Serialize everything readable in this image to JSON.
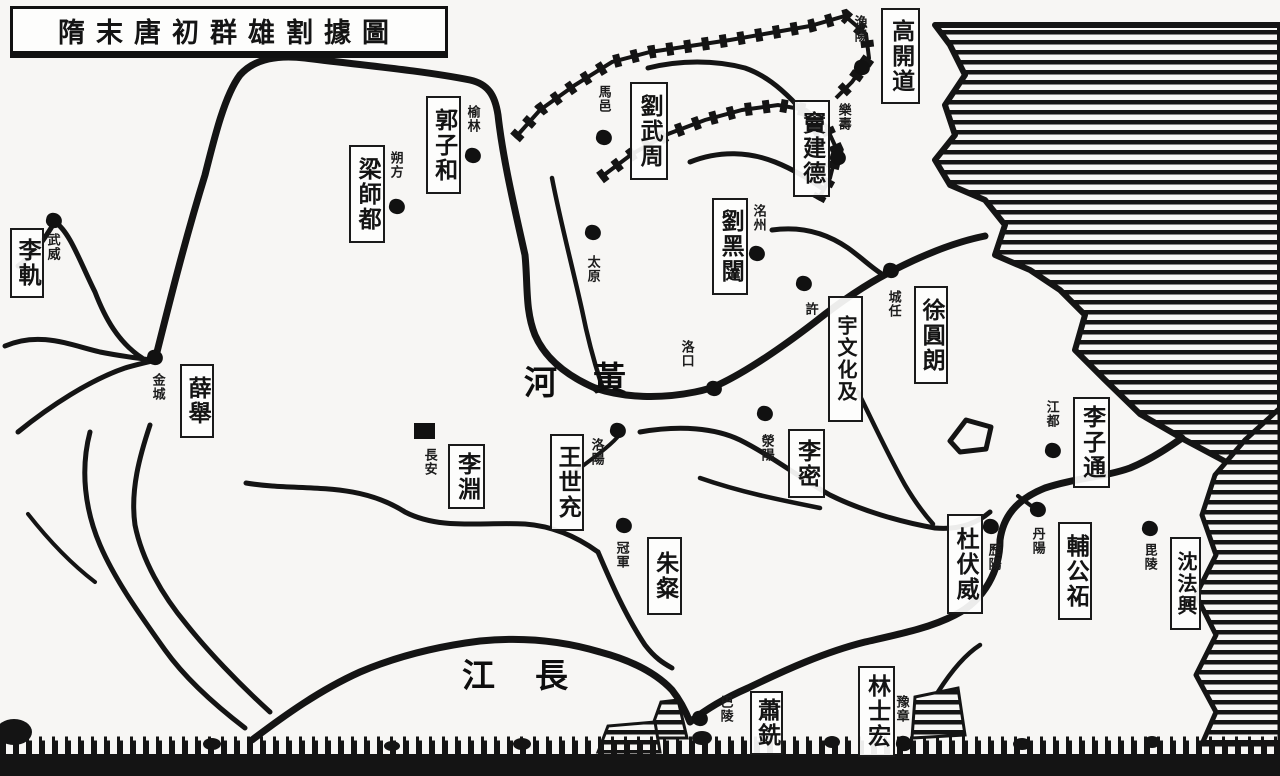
{
  "title": "隋末唐初群雄割據圖",
  "map": {
    "legend_hint": "",
    "warlords": [
      {
        "name": "高開道",
        "x": 881,
        "y": 8,
        "w": 39,
        "h": 96
      },
      {
        "name": "劉武周",
        "x": 630,
        "y": 82,
        "w": 38,
        "h": 98
      },
      {
        "name": "竇建德",
        "x": 793,
        "y": 100,
        "w": 37,
        "h": 97
      },
      {
        "name": "郭子和",
        "x": 426,
        "y": 96,
        "w": 35,
        "h": 98
      },
      {
        "name": "梁師都",
        "x": 349,
        "y": 145,
        "w": 36,
        "h": 98
      },
      {
        "name": "李軌",
        "x": 10,
        "y": 228,
        "w": 34,
        "h": 70
      },
      {
        "name": "劉黑闥",
        "x": 712,
        "y": 198,
        "w": 36,
        "h": 97
      },
      {
        "name": "薛舉",
        "x": 180,
        "y": 364,
        "w": 34,
        "h": 74
      },
      {
        "name": "宇文化及",
        "x": 828,
        "y": 296,
        "w": 35,
        "h": 126
      },
      {
        "name": "徐圓朗",
        "x": 914,
        "y": 286,
        "w": 34,
        "h": 98
      },
      {
        "name": "李淵",
        "x": 448,
        "y": 444,
        "w": 37,
        "h": 65
      },
      {
        "name": "王世充",
        "x": 550,
        "y": 434,
        "w": 34,
        "h": 97
      },
      {
        "name": "李密",
        "x": 788,
        "y": 429,
        "w": 37,
        "h": 69
      },
      {
        "name": "朱粲",
        "x": 647,
        "y": 537,
        "w": 35,
        "h": 78
      },
      {
        "name": "杜伏威",
        "x": 947,
        "y": 514,
        "w": 36,
        "h": 100
      },
      {
        "name": "輔公祏",
        "x": 1058,
        "y": 522,
        "w": 34,
        "h": 98
      },
      {
        "name": "李子通",
        "x": 1073,
        "y": 397,
        "w": 37,
        "h": 91
      },
      {
        "name": "沈法興",
        "x": 1170,
        "y": 537,
        "w": 31,
        "h": 93
      },
      {
        "name": "蕭銑",
        "x": 750,
        "y": 691,
        "w": 33,
        "h": 64
      },
      {
        "name": "林士宏",
        "x": 858,
        "y": 666,
        "w": 37,
        "h": 91
      }
    ],
    "places": [
      {
        "name": "武威",
        "lx": 45,
        "ly": 233,
        "mx": 46,
        "my": 213,
        "marker": "dot"
      },
      {
        "name": "金城",
        "lx": 150,
        "ly": 373,
        "mx": 147,
        "my": 350,
        "marker": "dot"
      },
      {
        "name": "朔方",
        "lx": 388,
        "ly": 151,
        "mx": 389,
        "my": 199,
        "marker": "dot"
      },
      {
        "name": "榆林",
        "lx": 465,
        "ly": 105,
        "mx": 465,
        "my": 148,
        "marker": "dot"
      },
      {
        "name": "馬邑",
        "lx": 596,
        "ly": 85,
        "mx": 596,
        "my": 130,
        "marker": "dot"
      },
      {
        "name": "太原",
        "lx": 585,
        "ly": 255,
        "mx": 585,
        "my": 225,
        "marker": "dot"
      },
      {
        "name": "漁陽",
        "lx": 852,
        "ly": 15,
        "mx": 854,
        "my": 60,
        "marker": "dot"
      },
      {
        "name": "樂壽",
        "lx": 836,
        "ly": 103,
        "mx": 830,
        "my": 150,
        "marker": "dot"
      },
      {
        "name": "洺州",
        "lx": 751,
        "ly": 204,
        "mx": 749,
        "my": 246,
        "marker": "dot"
      },
      {
        "name": "許",
        "lx": 803,
        "ly": 302,
        "mx": 796,
        "my": 276,
        "marker": "dot"
      },
      {
        "name": "洛口",
        "lx": 679,
        "ly": 340,
        "mx": 706,
        "my": 381,
        "marker": "dot"
      },
      {
        "name": "洛陽",
        "lx": 589,
        "ly": 438,
        "mx": 610,
        "my": 423,
        "marker": "dot"
      },
      {
        "name": "滎陽",
        "lx": 759,
        "ly": 434,
        "mx": 757,
        "my": 406,
        "marker": "dot"
      },
      {
        "name": "長安",
        "lx": 422,
        "ly": 448,
        "mx": 414,
        "my": 423,
        "marker": "square"
      },
      {
        "name": "城任",
        "lx": 886,
        "ly": 290,
        "mx": 883,
        "my": 263,
        "marker": "dot"
      },
      {
        "name": "冠軍",
        "lx": 614,
        "ly": 541,
        "mx": 616,
        "my": 518,
        "marker": "dot"
      },
      {
        "name": "江都",
        "lx": 1044,
        "ly": 400,
        "mx": 1045,
        "my": 443,
        "marker": "dot"
      },
      {
        "name": "歷陽",
        "lx": 986,
        "ly": 543,
        "mx": 983,
        "my": 519,
        "marker": "dot"
      },
      {
        "name": "丹陽",
        "lx": 1030,
        "ly": 527,
        "mx": 1030,
        "my": 502,
        "marker": "dot"
      },
      {
        "name": "毘陵",
        "lx": 1142,
        "ly": 543,
        "mx": 1142,
        "my": 521,
        "marker": "dot"
      },
      {
        "name": "巴陵",
        "lx": 718,
        "ly": 695,
        "mx": 692,
        "my": 711,
        "marker": "dot"
      },
      {
        "name": "豫章",
        "lx": 894,
        "ly": 695,
        "mx": 896,
        "my": 736,
        "marker": "dot"
      }
    ],
    "river_labels": [
      {
        "name": "河",
        "x": 524,
        "y": 356
      },
      {
        "name": "黃",
        "x": 593,
        "y": 352
      },
      {
        "name": "江",
        "x": 462,
        "y": 649
      },
      {
        "name": "長",
        "x": 535,
        "y": 649
      }
    ],
    "colors": {
      "ink": "#141414",
      "paper": "#f7f6f4"
    }
  }
}
